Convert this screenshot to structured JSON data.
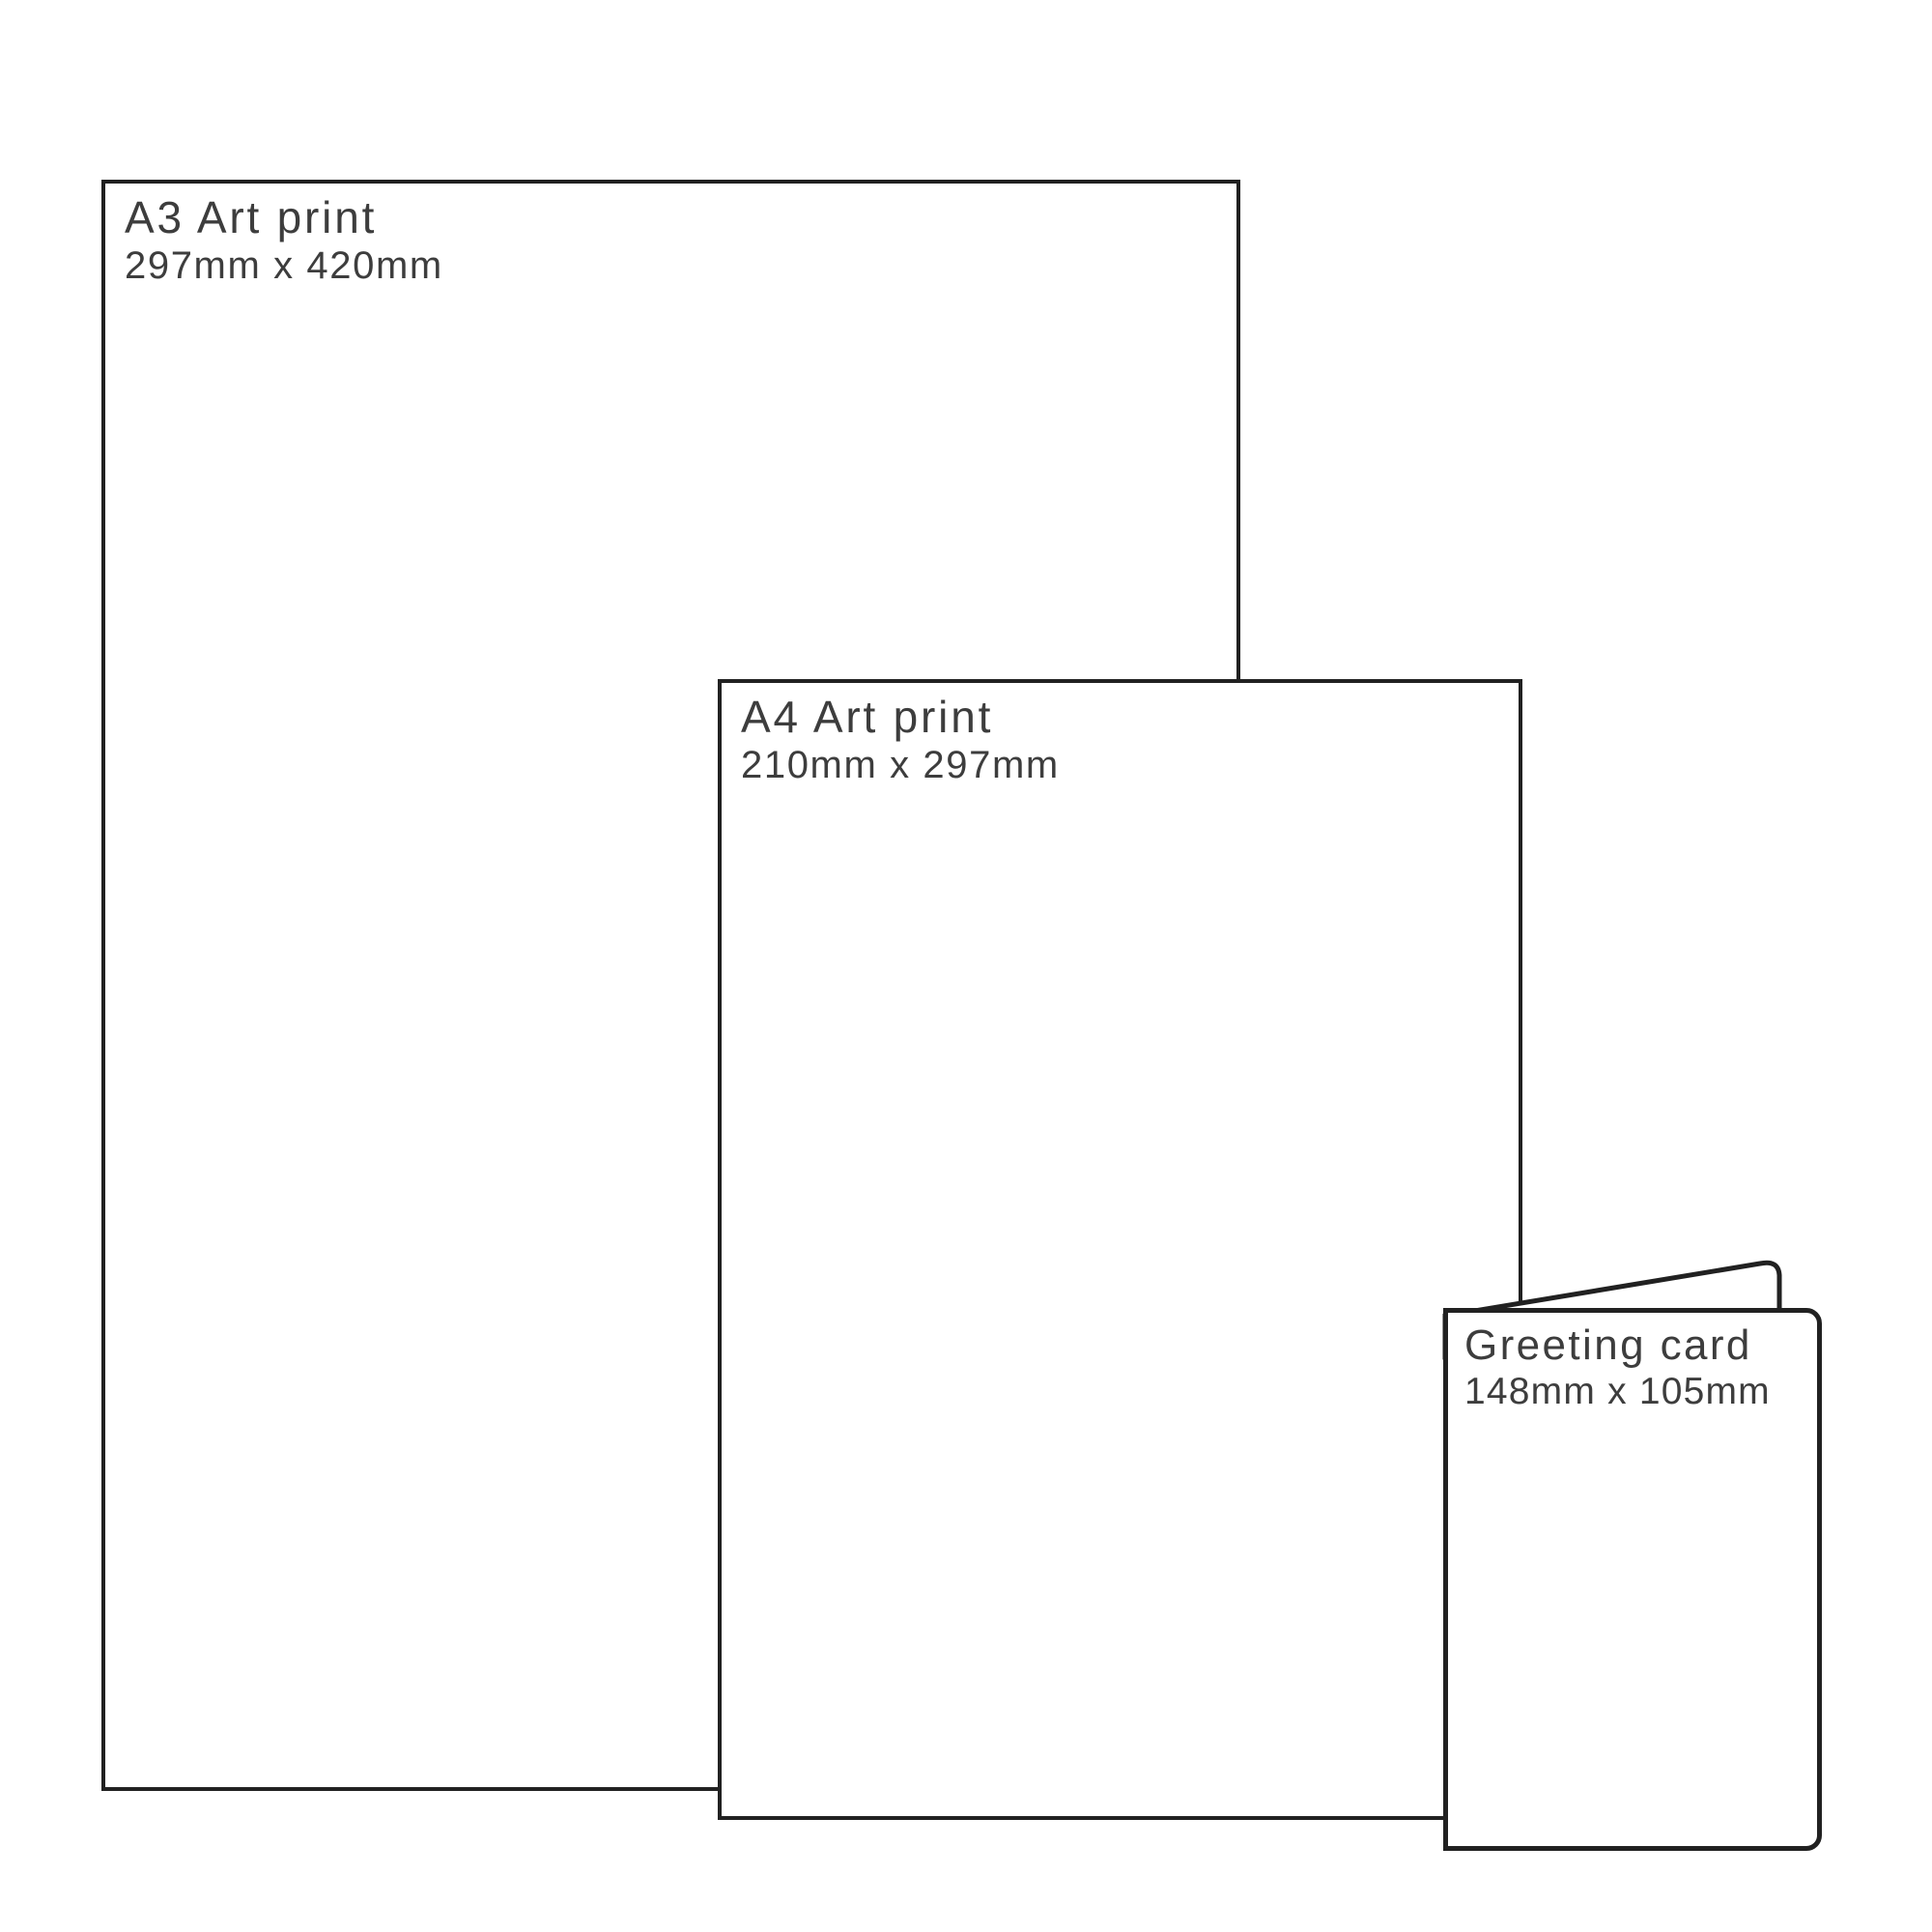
{
  "colors": {
    "outline": "#212121",
    "text": "#3d3d3d",
    "background": "#ffffff"
  },
  "items": [
    {
      "id": "a3-art-print",
      "title": "A3 Art print",
      "dimensions": "297mm x 420mm"
    },
    {
      "id": "a4-art-print",
      "title": "A4 Art print",
      "dimensions": "210mm x 297mm"
    },
    {
      "id": "greeting-card",
      "title": "Greeting card",
      "dimensions": "148mm x 105mm"
    }
  ]
}
